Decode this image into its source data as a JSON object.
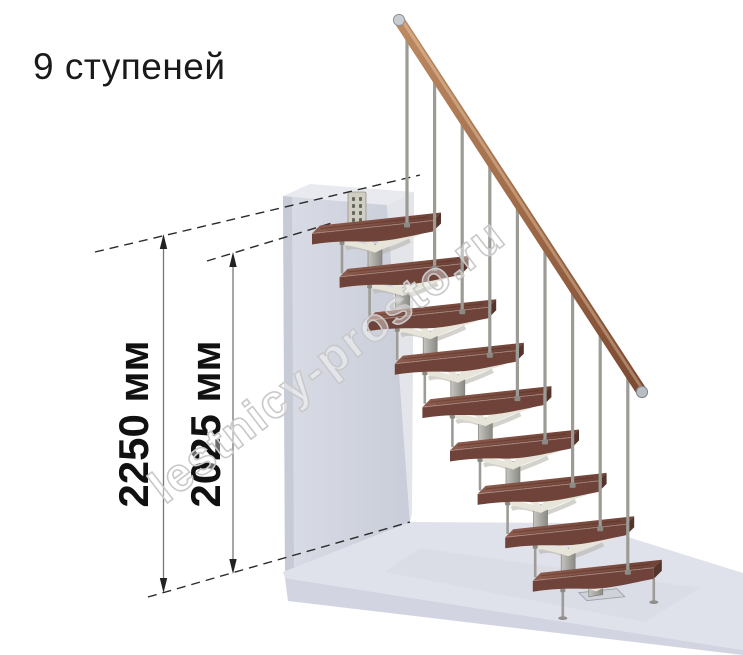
{
  "title": "9 ступеней",
  "steps_count": 9,
  "dimension_labels": {
    "total_height": "2250 мм",
    "tread_height": "2025 мм"
  },
  "watermark": "lestnicy-prosto.ru",
  "colors": {
    "background": "#ffffff",
    "text": "#1a1a1a",
    "dimension_line": "#777777",
    "arrow": "#222222",
    "dashed_line": "#2a2a2a",
    "wall_front": "#d3d6e0",
    "wall_top": "#e8eaf0",
    "wall_side_light": "#e3e5eb",
    "wall_edge_dark": "#c7cbd6",
    "floor_top": "#e0e2eb",
    "floor_front": "#d2d5e1",
    "floor_shadow": "#cdd1de",
    "tread_top_light": "#8c5b4d",
    "tread_top_dark": "#6f4237",
    "tread_front": "#6f4339",
    "tread_side": "#55342c",
    "metal": "#a9a8a2",
    "metal_dark": "#84837d",
    "rod": "#9d9c96",
    "branch": "#e7e4d9",
    "branch_back": "#b5b4ac",
    "rail_light": "#bd8a62",
    "rail_mid": "#a06b48",
    "rail_dark": "#7c4a32",
    "cap_silver": "#c9ccd1",
    "bracket": "#d0cdc3",
    "watermark_stroke": "#c9c9c9"
  }
}
